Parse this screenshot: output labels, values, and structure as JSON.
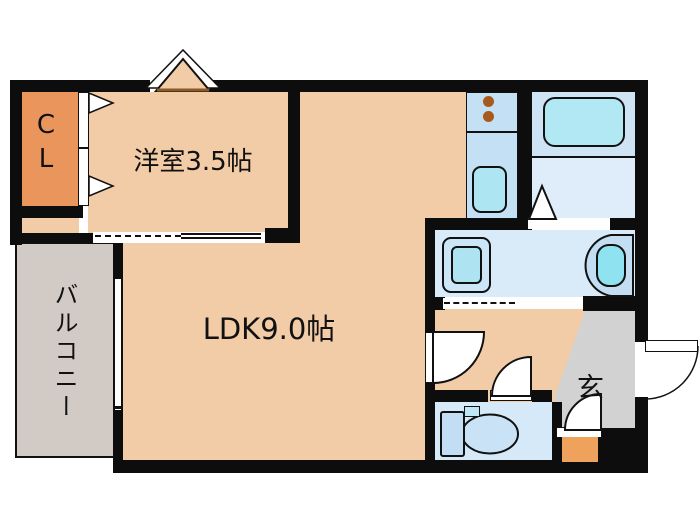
{
  "diagram_type": "japanese-apartment-floor-plan",
  "rooms": {
    "closet": {
      "label": "CL"
    },
    "western_room": {
      "label": "洋室3.5帖",
      "size_jo": "3.5"
    },
    "ldk": {
      "label": "LDK9.0帖",
      "size_jo": "9.0"
    },
    "balcony": {
      "label": "バルコニー"
    },
    "entrance": {
      "label": "玄"
    }
  },
  "fixtures": [
    "bay-window",
    "closet-folding-door",
    "kitchen-counter",
    "stove-burners",
    "kitchen-sink",
    "bathtub",
    "bathroom-door-triangle",
    "washing-machine-pan",
    "washbasin",
    "toilet",
    "entrance-step",
    "front-door-swing",
    "interior-door-swings",
    "sliding-door-tracks",
    "window"
  ],
  "colors": {
    "wall": "#0d0d0d",
    "room_peach": "#F2CBA7",
    "closet_orange": "#E9955C",
    "step_orange": "#EFA25C",
    "balcony_gray": "#D2CAC4",
    "entrance_gray": "#D2D2D2",
    "water_room_blue": "#D9EAF8",
    "bath_blue": "#CEE4F5",
    "fixture_cyan": "#B2E8F3",
    "burner_brown": "#A75A1C",
    "background": "#ffffff"
  }
}
